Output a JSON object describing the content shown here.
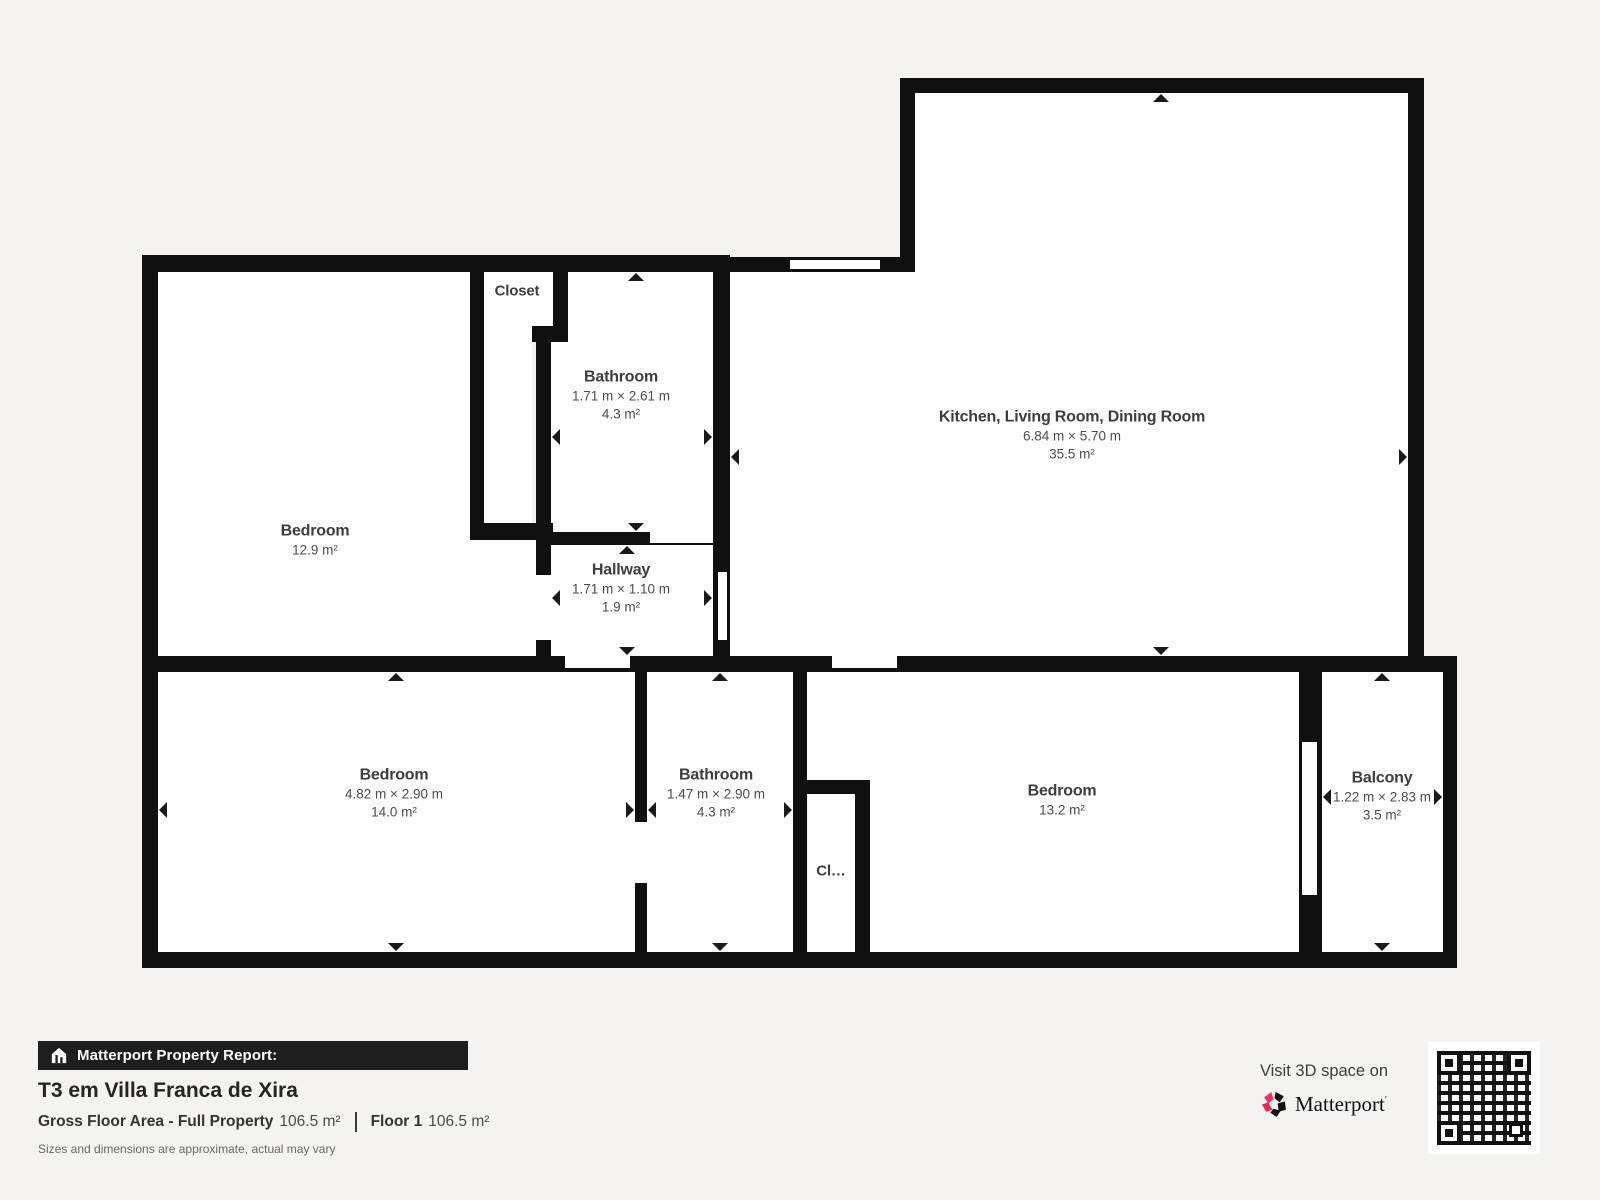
{
  "plan": {
    "rooms": [
      {
        "id": "bedroom-top-left",
        "name": "Bedroom",
        "dims": "",
        "area": "12.9 m²"
      },
      {
        "id": "closet-top",
        "name": "Closet",
        "dims": "",
        "area": ""
      },
      {
        "id": "bathroom-top",
        "name": "Bathroom",
        "dims": "1.71 m × 2.61 m",
        "area": "4.3 m²"
      },
      {
        "id": "hallway",
        "name": "Hallway",
        "dims": "1.71 m × 1.10 m",
        "area": "1.9 m²"
      },
      {
        "id": "kitchen-living-dining",
        "name": "Kitchen, Living Room, Dining Room",
        "dims": "6.84 m × 5.70 m",
        "area": "35.5 m²"
      },
      {
        "id": "bedroom-bottom-left",
        "name": "Bedroom",
        "dims": "4.82 m × 2.90 m",
        "area": "14.0 m²"
      },
      {
        "id": "bathroom-bottom",
        "name": "Bathroom",
        "dims": "1.47 m × 2.90 m",
        "area": "4.3 m²"
      },
      {
        "id": "closet-bottom",
        "name": "Cl…",
        "dims": "",
        "area": ""
      },
      {
        "id": "bedroom-bottom-right",
        "name": "Bedroom",
        "dims": "",
        "area": "13.2 m²"
      },
      {
        "id": "balcony",
        "name": "Balcony",
        "dims": "1.22 m × 2.83 m",
        "area": "3.5 m²"
      }
    ]
  },
  "footer": {
    "report_label": "Matterport Property Report:",
    "property_title": "T3 em Villa Franca de Xira",
    "gross_label": "Gross Floor Area - Full Property",
    "gross_value": "106.5 m²",
    "floor_label": "Floor 1",
    "floor_value": "106.5 m²",
    "disclaimer": "Sizes and dimensions are approximate, actual may vary",
    "visit_label": "Visit 3D space on",
    "brand": "Matterport",
    "brand_mark": "′"
  },
  "icons": {
    "report_bar": "house-icon",
    "brand": "matterport-pinwheel-icon",
    "qr": "qr-code",
    "door_markers": "triangle-arrows"
  },
  "colors": {
    "background": "#f4f3f1",
    "wall": "#101010",
    "room_fill": "#ffffff",
    "brand_pink": "#f5315a",
    "brand_red": "#e22850",
    "bar_background": "#1e1e1e"
  }
}
